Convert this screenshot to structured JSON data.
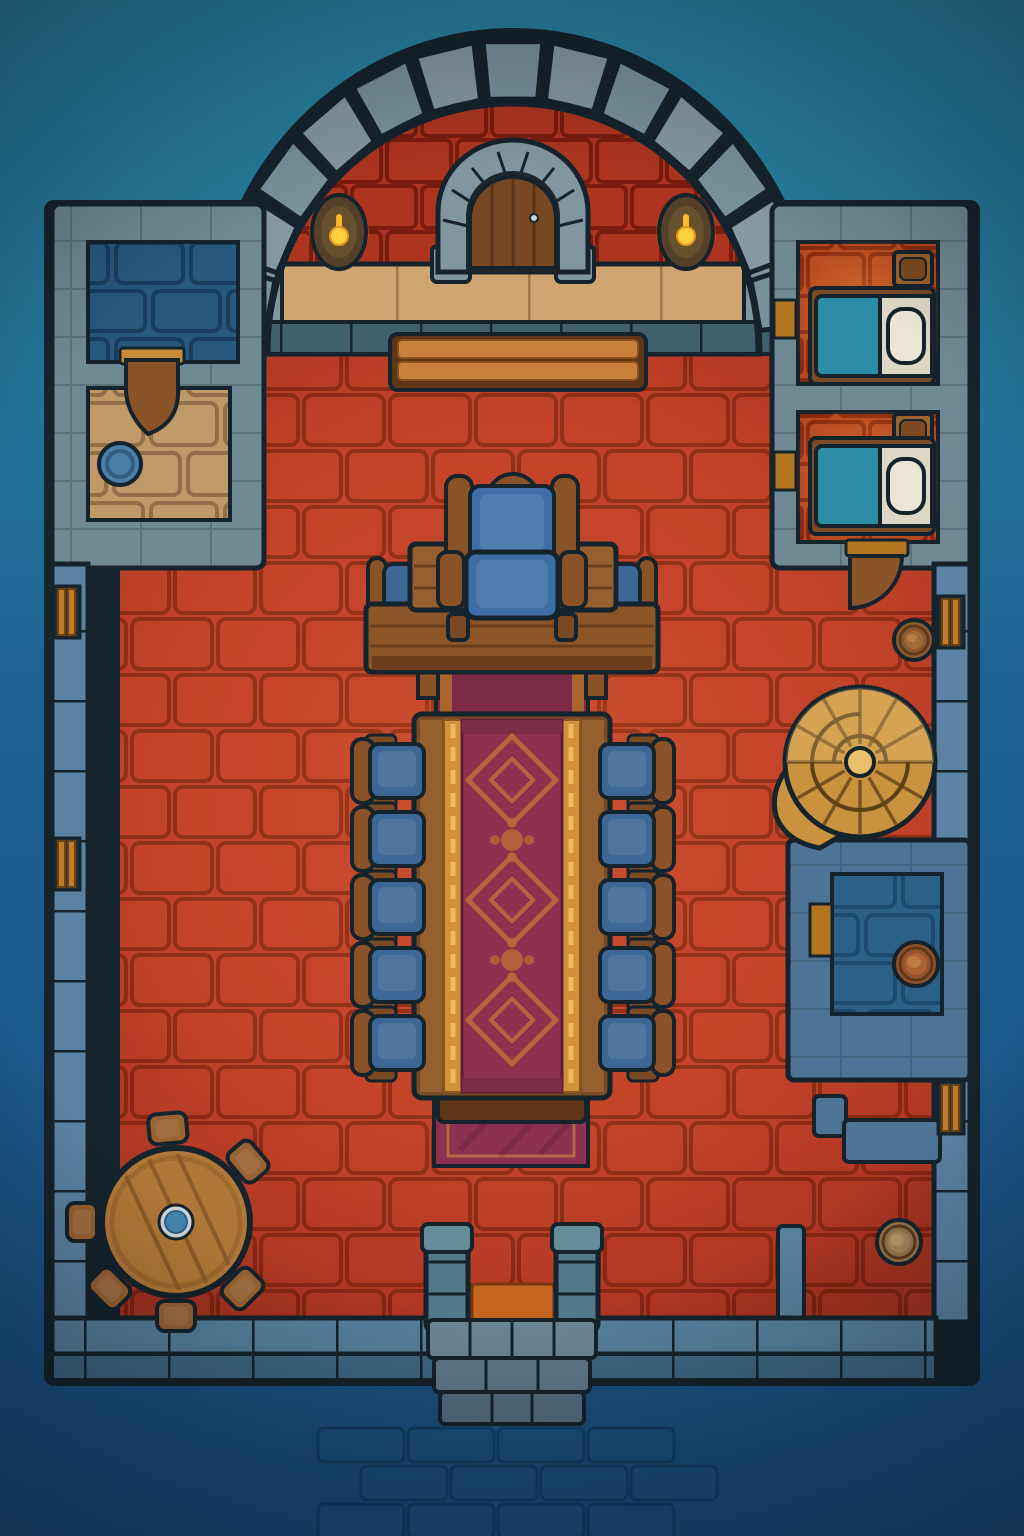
{
  "meta": {
    "kind": "top-down fantasy battlemap",
    "setting": "castle great hall with throne, feast table, bedrooms and cellar rooms",
    "text_on_screen": "none"
  },
  "palette": {
    "bg_top": "#2a83a0",
    "bg_mid": "#1d6394",
    "bg_bottom": "#1a4c7c",
    "outline": "#15232c",
    "wall_gray": "#6f8a94",
    "wall_blue": "#4d7494",
    "wall_blue_light": "#5b82a2",
    "floor_red": "#c2402a",
    "mortar_red": "#8d2a16",
    "wall_red": "#ad3520",
    "walkway_tan": "#cfa671",
    "room_tan": "#bf9968",
    "floor_blue": "#27587e",
    "floor_blue2": "#2b6089",
    "bedroom_orange": "#b5481f",
    "wood": "#8a5226",
    "wood_dark": "#5f3517",
    "wood_light": "#c9813a",
    "gold": "#d1913b",
    "carpet": "#8e3050",
    "carpet_motif": "#b8653c",
    "cushion_blue": "#3f6ea6",
    "blanket_teal": "#2e8da6",
    "linen": "#ddd7c6",
    "stair_gold": "#c9923f",
    "flame": "#ffd23e"
  },
  "furniture": {
    "throne": 1,
    "dais_tables": 2,
    "long_feast_table": 1,
    "dining_chairs": 10,
    "head_chairs": 2,
    "beds": 2,
    "nightstands": 2,
    "bench": 1,
    "round_table": 1,
    "stools": 6,
    "barrels": 3,
    "spiral_staircase": 1,
    "torch_sconces": 2,
    "wall_windows": 4,
    "wooden_doors": 3,
    "main_double_door": 1,
    "entrance_steps": 1,
    "basin": 1
  },
  "generated": {
    "arch": {
      "cx": 513,
      "cy": 352,
      "rx_out": 300,
      "ry_out": 312,
      "rx_in": 248,
      "ry_in": 254,
      "deg_start": 184,
      "deg_end": 356,
      "stones": 13
    },
    "torches": [
      {
        "cx": 339,
        "cy": 232
      },
      {
        "cx": 686,
        "cy": 232
      }
    ],
    "dining_chairs": {
      "rows_y": [
        744,
        812,
        880,
        948,
        1016
      ],
      "left": {
        "back_x": 352,
        "seat_x": 370
      },
      "right": {
        "back_x": 652,
        "seat_x": 600
      },
      "seat_w": 54,
      "seat_h": 54,
      "back_w": 22,
      "back_h": 64
    },
    "stools": {
      "cx": 176,
      "cy": 1222,
      "radius": 94,
      "angles_deg": [
        -95,
        -40,
        45,
        90,
        135,
        180
      ],
      "w": 38,
      "h": 30
    },
    "barrels": [
      {
        "cx": 914,
        "cy": 640,
        "r": 20,
        "base": "#8a5a30",
        "mid": "#a06b38",
        "top": "#b57f47"
      },
      {
        "cx": 916,
        "cy": 964,
        "r": 22,
        "base": "#96522c",
        "mid": "#aa6234",
        "top": "#bf7a42"
      },
      {
        "cx": 899,
        "cy": 1242,
        "r": 22,
        "base": "#93754c",
        "mid": "#a5875a",
        "top": "#b99a68"
      }
    ],
    "windows": [
      {
        "x": 54,
        "y": 586
      },
      {
        "x": 54,
        "y": 838
      },
      {
        "x": 938,
        "y": 596
      },
      {
        "x": 938,
        "y": 1082
      }
    ],
    "bedrooms": [
      {
        "room_y": 242,
        "room_h": 142,
        "bed_y": 296,
        "stand_y": 252,
        "door_y": 300
      },
      {
        "room_y": 412,
        "room_h": 130,
        "bed_y": 446,
        "stand_y": 414,
        "door_y": 452
      }
    ],
    "runner_pattern": {
      "cx": 512,
      "diamond_y": [
        780,
        900,
        1020
      ],
      "orb_y": [
        840,
        960
      ]
    },
    "spiral": {
      "cx": 860,
      "cy": 762,
      "r": 75,
      "spoke_deg": [
        0,
        30,
        60,
        90,
        120,
        150,
        180,
        210,
        240,
        270,
        300,
        330
      ]
    },
    "bg_bricks": {
      "rows_y": [
        1428,
        1466,
        1504
      ],
      "x0": 318,
      "x1": 710,
      "w": 86,
      "h": 34
    }
  }
}
